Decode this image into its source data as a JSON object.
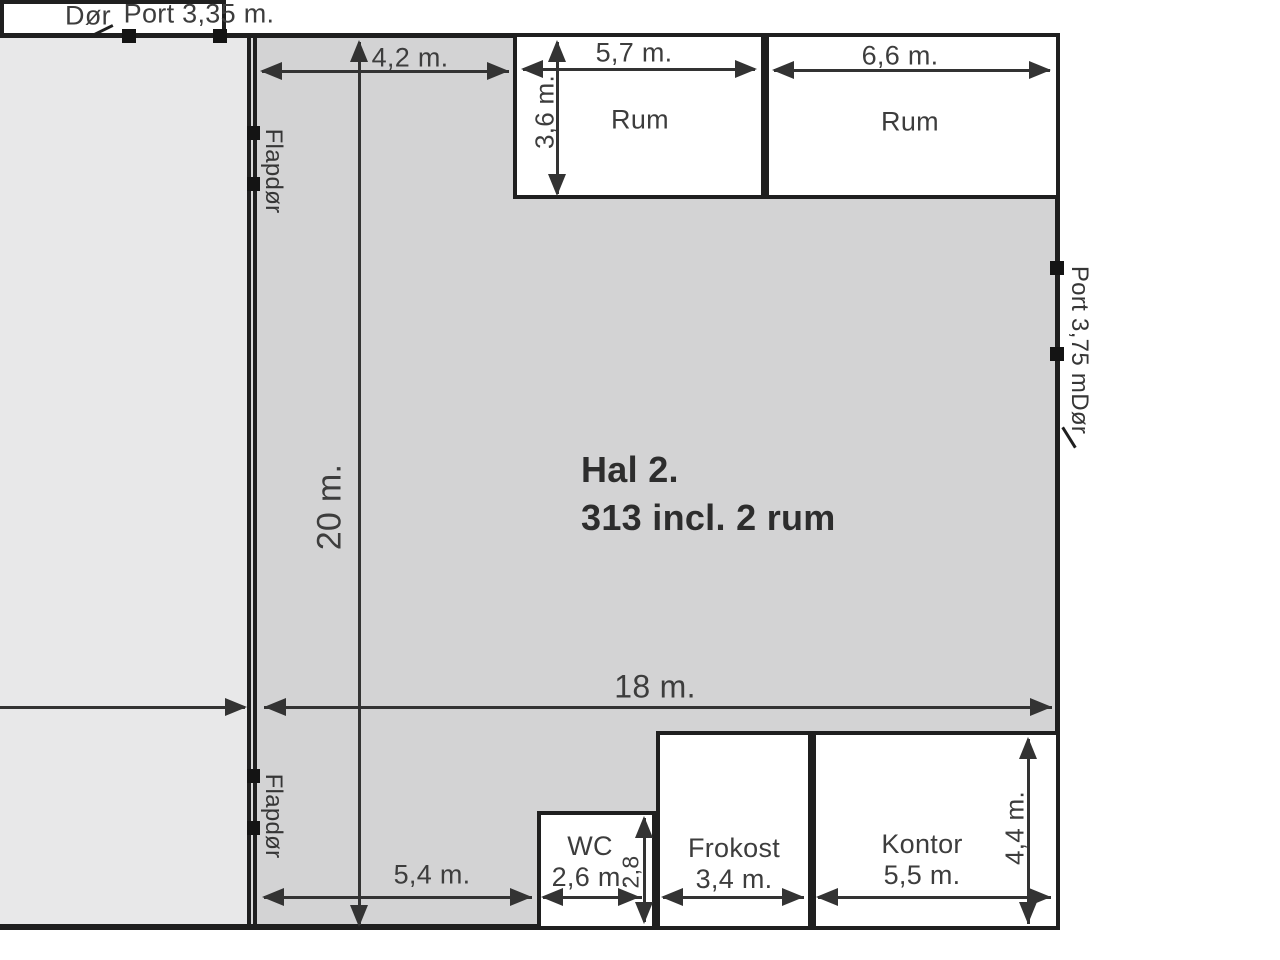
{
  "plan": {
    "hall2": {
      "title": "Hal 2.",
      "subtitle": "313 incl. 2 rum"
    },
    "rooms": {
      "rum_left": "Rum",
      "rum_right": "Rum",
      "wc": "WC",
      "frokost": "Frokost",
      "kontor": "Kontor"
    },
    "doors": {
      "top_door": "Dør",
      "top_port": "Port 3,35 m.",
      "left_flapdoor_top": "Flapdør",
      "left_flapdoor_bottom": "Flapdør",
      "right_port": "Port 3,75 m",
      "right_door": "Dør"
    },
    "dimensions": {
      "offset_top": "4,2 m.",
      "rum_left_width": "5,7 m.",
      "rum_left_depth": "3,6 m.",
      "rum_right_width": "6,6 m.",
      "hall_depth": "20 m.",
      "hall_width": "18 m.",
      "offset_bottom": "5,4 m.",
      "wc_width": "2,6 m.",
      "wc_depth": "2,8",
      "frokost_width": "3,4 m.",
      "kontor_width": "5,5 m.",
      "kontor_depth": "4,4 m."
    },
    "colors": {
      "hall_left_fill": "#e8e8e9",
      "hall2_fill": "#d3d3d4",
      "room_fill": "#ffffff",
      "wall": "#1f1f1f",
      "dim_line": "#333333",
      "label_text": "#3d3d3d"
    }
  }
}
